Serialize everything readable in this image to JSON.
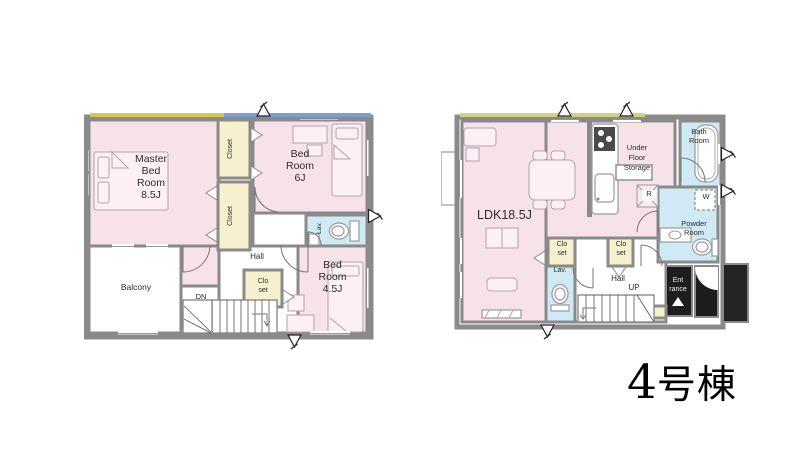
{
  "title": {
    "number": "4",
    "suffix": "号棟"
  },
  "colors": {
    "room_pink": "#f8e2ea",
    "closet_cream": "#f6f0cf",
    "wet_blue": "#cfe9f5",
    "wall_gray": "#8a8a8a",
    "accent_yellow": "#d6c750",
    "accent_blue": "#7e9fd0",
    "accent_green": "#d2d382",
    "entrance_black": "#1d1d1d",
    "porch_dark": "#242424"
  },
  "floor2": {
    "labels": {
      "master": "Master\nBed\nRoom\n8.5J",
      "closet_a": "Closet",
      "closet_b": "Closet",
      "bedroom6": "Bed\nRoom\n6J",
      "lav": "Lav.",
      "hall": "Hall",
      "closet_c": "Clo\nset",
      "bedroom45": "Bed\nRoom\n4.5J",
      "balcony": "Balcony",
      "down": "DN"
    }
  },
  "floor1": {
    "labels": {
      "ldk": "LDK18.5J",
      "under_floor_storage": "Under\nFloor\nStorage",
      "bath": "Bath\nRoom",
      "fridge": "R",
      "washer": "W",
      "powder": "Powder\nRoom",
      "closet_a": "Clo\nset",
      "closet_b": "Clo\nset",
      "lav": "Lav.",
      "hall": "Hall",
      "up": "UP",
      "entrance": "Ent\nrance"
    }
  }
}
